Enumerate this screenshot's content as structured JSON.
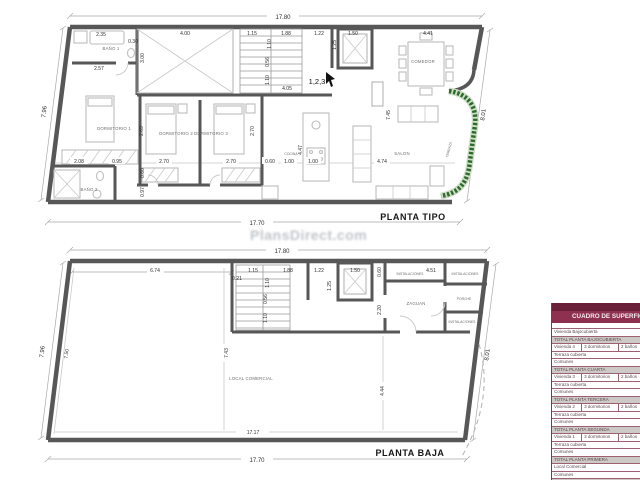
{
  "watermark": "PlansDirect.com",
  "plan_tipo": {
    "title": "PLANTA TIPO",
    "annotation": "1,2,3",
    "rooms": {
      "bano1": "BAÑO 1",
      "bano2": "BAÑO 2",
      "dorm1": "DORMITORIO 1",
      "dorm2": "DORMITORIO 2",
      "dorm3": "DORMITORIO 3",
      "cocina": "COCINA",
      "comedor": "COMEDOR",
      "salon": "SALON",
      "terraza": "TERRAZA"
    },
    "dims": {
      "total_top": "17.80",
      "total_bottom": "17.70",
      "left": "7.96",
      "right": "8.01",
      "d235": "2.35",
      "d030": "0.30",
      "d400": "4.00",
      "d115": "1.15",
      "d188": "1.88",
      "d122": "1.22",
      "d150": "1.50",
      "d441": "4.41",
      "d257": "2.57",
      "d300": "3.00",
      "d110a": "1.10",
      "d056": "0.56",
      "d110b": "1.10",
      "d125": "1.25",
      "d405": "4.05",
      "d208": "2.08",
      "d095": "0.95",
      "d270a": "2.70",
      "d270b": "2.70",
      "d060a": "0.60",
      "d100a": "1.00",
      "d100b": "1.00",
      "d474": "4.74",
      "d269": "2.69",
      "d270c": "2.70",
      "d060b": "0.60",
      "d097": "0.97",
      "d447": "4.47",
      "d745": "7.45"
    }
  },
  "plan_baja": {
    "title": "PLANTA BAJA",
    "rooms": {
      "local": "LOCAL COMERCIAL",
      "zaguan": "ZAGUAN",
      "porche": "PORCHE",
      "inst1": "INSTALACIONES",
      "inst2": "INSTALACIONES",
      "inst3": "INSTALACIONES"
    },
    "dims": {
      "total_top": "17.80",
      "total_bottom": "17.70",
      "inner_bottom": "17.17",
      "left_outer": "7.96",
      "left_inner": "7.50",
      "right": "8.01",
      "d674": "6.74",
      "d021": "0.21",
      "d115": "1.15",
      "d188": "1.88",
      "d122": "1.22",
      "d150": "1.50",
      "d451": "4.51",
      "d110a": "1.10",
      "d056": "0.56",
      "d110b": "1.10",
      "d125": "1.25",
      "d060": "0.60",
      "d220": "2.20",
      "d743": "7.43",
      "d444": "4.44"
    }
  },
  "table": {
    "title": "CUADRO DE SUPERFICIES",
    "rows": [
      {
        "t": "n",
        "c": [
          "Vivienda Bajocubierta"
        ]
      },
      {
        "t": "total",
        "c": [
          "TOTAL PLANTA BAJOCUBIERTA"
        ]
      },
      {
        "t": "unit",
        "c": [
          "Vivienda  4",
          "3 dormitorios",
          "2 baños"
        ]
      },
      {
        "t": "n",
        "c": [
          "Terraza cubierta"
        ]
      },
      {
        "t": "n",
        "c": [
          "Comunes"
        ]
      },
      {
        "t": "total",
        "c": [
          "TOTAL PLANTA CUARTA"
        ]
      },
      {
        "t": "unit",
        "c": [
          "Vivienda  3",
          "3 dormitorios",
          "2 baños"
        ]
      },
      {
        "t": "n",
        "c": [
          "Terraza cubierta"
        ]
      },
      {
        "t": "n",
        "c": [
          "Comunes"
        ]
      },
      {
        "t": "total",
        "c": [
          "TOTAL PLANTA TERCERA"
        ]
      },
      {
        "t": "unit",
        "c": [
          "Vivienda  2",
          "3 dormitorios",
          "2 baños"
        ]
      },
      {
        "t": "n",
        "c": [
          "Terraza cubierta"
        ]
      },
      {
        "t": "n",
        "c": [
          "Comunes"
        ]
      },
      {
        "t": "total",
        "c": [
          "TOTAL PLANTA SEGUNDA"
        ]
      },
      {
        "t": "unit",
        "c": [
          "Vivienda  1",
          "3 dormitorios",
          "2 baños"
        ]
      },
      {
        "t": "n",
        "c": [
          "Terraza cubierta"
        ]
      },
      {
        "t": "n",
        "c": [
          "Comunes"
        ]
      },
      {
        "t": "total",
        "c": [
          "TOTAL PLANTA PRIMERA"
        ]
      },
      {
        "t": "n",
        "c": [
          "Local Comercial"
        ]
      },
      {
        "t": "n",
        "c": [
          "Comunes"
        ]
      },
      {
        "t": "total",
        "c": [
          "TOTAL PLANTA BAJA"
        ]
      },
      {
        "t": "n",
        "c": [
          "SUPERFICIE TOTAL"
        ]
      }
    ]
  }
}
